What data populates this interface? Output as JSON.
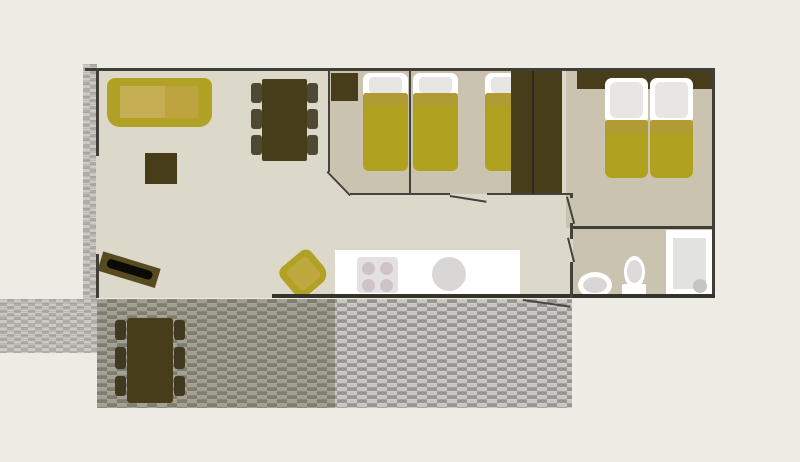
{
  "palette": {
    "background": "#edece4",
    "floor_light": "#dcd8ca",
    "floor_dark": "#c9c3b0",
    "wall": "#403e37",
    "furniture_dark_brown": "#483d1b",
    "upholstery_olive": "#b1a124",
    "cushion_light_olive": "#c4ad52",
    "bed_cover_olive": "#b0a21f",
    "bed_cover_fold": "#b19b33",
    "white": "#ffffff",
    "pillow_gray": "#e7e6e3",
    "fixture_gray": "#d9d7d5",
    "deck_gray": "#b0aea7",
    "deck_shade": "rgba(77,71,41,0.30)"
  },
  "plan": {
    "canvas": {
      "w": 800,
      "h": 462,
      "bg": "#edece4"
    },
    "elements": [
      {
        "n": "side-walkway-deck",
        "x": 83,
        "y": 64,
        "w": 14,
        "h": 236,
        "pat": "walk"
      },
      {
        "n": "front-walkway-deck",
        "x": 0,
        "y": 299,
        "w": 97,
        "h": 54,
        "pat": "walk"
      },
      {
        "n": "terrace-deck",
        "x": 97,
        "y": 299,
        "w": 475,
        "h": 109,
        "pat": "deck"
      },
      {
        "n": "terrace-deck-shade",
        "x": 97,
        "y": 299,
        "w": 238,
        "h": 109,
        "c": "rgba(77,71,41,0.30)"
      },
      {
        "n": "terrace-edge-line",
        "x": 523,
        "y": 299,
        "w": 48,
        "h": 2,
        "c": "#4a4840",
        "rot": 8,
        "org": "0 0"
      },
      {
        "n": "living-area-floor",
        "x": 96,
        "y": 68,
        "w": 619,
        "h": 230,
        "c": "#dcd8ca"
      },
      {
        "n": "bedroom1-floor",
        "x": 330,
        "y": 71,
        "w": 80,
        "h": 123,
        "c": "#c9c3b0",
        "clip": "polygon(0 0,100% 0,100% 100%,26% 100%,0 82%)"
      },
      {
        "n": "bedroom2-floor",
        "x": 410,
        "y": 71,
        "w": 123,
        "h": 123,
        "c": "#c9c3b0"
      },
      {
        "n": "master-bedroom-floor",
        "x": 566,
        "y": 71,
        "w": 146,
        "h": 157,
        "c": "#c9c3b0"
      },
      {
        "n": "bathroom-floor",
        "x": 573,
        "y": 228,
        "w": 139,
        "h": 70,
        "c": "#c9c3b0"
      },
      {
        "n": "sofa",
        "x": 107,
        "y": 78,
        "w": 105,
        "h": 49,
        "c": "#b1a124",
        "r": "8px 8px 13px 13px"
      },
      {
        "n": "sofa-cushion-left",
        "x": 120,
        "y": 86,
        "w": 45,
        "h": 32,
        "c": "#c4ad52"
      },
      {
        "n": "sofa-cushion-right",
        "x": 165,
        "y": 86,
        "w": 33,
        "h": 32,
        "c": "#bda43e"
      },
      {
        "n": "coffee-table",
        "x": 145,
        "y": 153,
        "w": 32,
        "h": 31,
        "c": "#483d1b"
      },
      {
        "n": "dining-chair",
        "x": 251,
        "y": 83,
        "w": 11,
        "h": 20,
        "c": "#4f4933",
        "r": "3px"
      },
      {
        "n": "dining-chair",
        "x": 251,
        "y": 109,
        "w": 11,
        "h": 20,
        "c": "#4f4933",
        "r": "3px"
      },
      {
        "n": "dining-chair",
        "x": 251,
        "y": 135,
        "w": 11,
        "h": 20,
        "c": "#4f4933",
        "r": "3px"
      },
      {
        "n": "dining-chair",
        "x": 307,
        "y": 83,
        "w": 11,
        "h": 20,
        "c": "#4f4933",
        "r": "3px"
      },
      {
        "n": "dining-chair",
        "x": 307,
        "y": 109,
        "w": 11,
        "h": 20,
        "c": "#4f4933",
        "r": "3px"
      },
      {
        "n": "dining-chair",
        "x": 307,
        "y": 135,
        "w": 11,
        "h": 20,
        "c": "#4f4933",
        "r": "3px"
      },
      {
        "n": "dining-table",
        "x": 262,
        "y": 79,
        "w": 45,
        "h": 82,
        "c": "#483d1b",
        "r": "2px"
      },
      {
        "n": "tv-unit",
        "x": 99,
        "y": 258,
        "w": 62,
        "h": 24,
        "rot": 17,
        "ch": [
          {
            "n": "tv-bench",
            "x": 0,
            "y": 2,
            "w": 60,
            "h": 20,
            "c": "#564a1e"
          },
          {
            "n": "tv-screen",
            "x": 7,
            "y": 7,
            "w": 47,
            "h": 9,
            "c": "#0b0a07",
            "r": "4px"
          }
        ]
      },
      {
        "n": "armchair",
        "x": 282,
        "y": 252,
        "w": 42,
        "h": 42,
        "rot": -40,
        "ch": [
          {
            "n": "armchair-body",
            "x": 1,
            "y": 3,
            "w": 40,
            "h": 38,
            "c": "#b1a124",
            "r": "8px 8px 12px 12px"
          },
          {
            "n": "armchair-cushion",
            "x": 8,
            "y": 9,
            "w": 26,
            "h": 26,
            "c": "#bfa83e",
            "r": "4px"
          }
        ]
      },
      {
        "n": "bedroom1-cabinet",
        "x": 331,
        "y": 73,
        "w": 27,
        "h": 28,
        "c": "#483d1b"
      },
      {
        "n": "single-bed",
        "x": 363,
        "y": 73,
        "w": 45,
        "h": 98,
        "ch": [
          {
            "n": "bed-mattress",
            "x": 0,
            "y": 0,
            "w": 45,
            "h": 37,
            "c": "#ffffff",
            "r": "7px 7px 2px 2px"
          },
          {
            "n": "bed-pillow",
            "x": 6,
            "y": 4,
            "w": 33,
            "h": 16,
            "c": "#e7e6e3",
            "r": "4px"
          },
          {
            "n": "bed-cover",
            "x": 0,
            "y": 20,
            "w": 45,
            "h": 78,
            "c": "#b0a21f",
            "r": "3px 3px 6px 6px"
          },
          {
            "n": "bed-cover-fold",
            "x": 0,
            "y": 20,
            "w": 45,
            "h": 13,
            "c": "#b19b33",
            "r": "3px 3px 0 0"
          }
        ]
      },
      {
        "n": "single-bed",
        "x": 413,
        "y": 73,
        "w": 45,
        "h": 98,
        "ch": [
          {
            "n": "bed-mattress",
            "x": 0,
            "y": 0,
            "w": 45,
            "h": 37,
            "c": "#ffffff",
            "r": "7px 7px 2px 2px"
          },
          {
            "n": "bed-pillow",
            "x": 6,
            "y": 4,
            "w": 33,
            "h": 16,
            "c": "#e7e6e3",
            "r": "4px"
          },
          {
            "n": "bed-cover",
            "x": 0,
            "y": 20,
            "w": 45,
            "h": 78,
            "c": "#b0a21f",
            "r": "3px 3px 6px 6px"
          },
          {
            "n": "bed-cover-fold",
            "x": 0,
            "y": 20,
            "w": 45,
            "h": 13,
            "c": "#b19b33",
            "r": "3px 3px 0 0"
          }
        ]
      },
      {
        "n": "single-bed",
        "x": 485,
        "y": 73,
        "w": 45,
        "h": 98,
        "ch": [
          {
            "n": "bed-mattress",
            "x": 0,
            "y": 0,
            "w": 45,
            "h": 37,
            "c": "#ffffff",
            "r": "7px 7px 2px 2px"
          },
          {
            "n": "bed-pillow",
            "x": 6,
            "y": 4,
            "w": 33,
            "h": 16,
            "c": "#e7e6e3",
            "r": "4px"
          },
          {
            "n": "bed-cover",
            "x": 0,
            "y": 20,
            "w": 45,
            "h": 78,
            "c": "#b0a21f",
            "r": "3px 3px 6px 6px"
          },
          {
            "n": "bed-cover-fold",
            "x": 0,
            "y": 20,
            "w": 45,
            "h": 13,
            "c": "#b19b33",
            "r": "3px 3px 0 0"
          }
        ]
      },
      {
        "n": "bedroom2-wardrobe",
        "x": 511,
        "y": 71,
        "w": 21,
        "h": 123,
        "c": "#483d1b"
      },
      {
        "n": "master-wardrobe",
        "x": 534,
        "y": 71,
        "w": 28,
        "h": 123,
        "c": "#483d1b"
      },
      {
        "n": "master-headboard",
        "x": 577,
        "y": 71,
        "w": 135,
        "h": 18,
        "c": "#483d1b"
      },
      {
        "n": "double-bed-half",
        "x": 605,
        "y": 78,
        "w": 43,
        "h": 100,
        "ch": [
          {
            "n": "bed-mattress",
            "x": 0,
            "y": 0,
            "w": 43,
            "h": 46,
            "c": "#ffffff",
            "r": "7px"
          },
          {
            "n": "bed-pillow",
            "x": 5,
            "y": 4,
            "w": 33,
            "h": 36,
            "c": "#e7e6e3",
            "r": "6px"
          },
          {
            "n": "bed-cover",
            "x": 0,
            "y": 42,
            "w": 43,
            "h": 58,
            "c": "#b0a21f",
            "r": "3px 3px 7px 7px"
          },
          {
            "n": "bed-cover-fold",
            "x": 0,
            "y": 42,
            "w": 43,
            "h": 14,
            "c": "#b19b33",
            "r": "3px 3px 0 0"
          }
        ]
      },
      {
        "n": "double-bed-half",
        "x": 650,
        "y": 78,
        "w": 43,
        "h": 100,
        "ch": [
          {
            "n": "bed-mattress",
            "x": 0,
            "y": 0,
            "w": 43,
            "h": 46,
            "c": "#ffffff",
            "r": "7px"
          },
          {
            "n": "bed-pillow",
            "x": 5,
            "y": 4,
            "w": 33,
            "h": 36,
            "c": "#e7e6e3",
            "r": "6px"
          },
          {
            "n": "bed-cover",
            "x": 0,
            "y": 42,
            "w": 43,
            "h": 58,
            "c": "#b0a21f",
            "r": "3px 3px 7px 7px"
          },
          {
            "n": "bed-cover-fold",
            "x": 0,
            "y": 42,
            "w": 43,
            "h": 14,
            "c": "#b19b33",
            "r": "3px 3px 0 0"
          }
        ]
      },
      {
        "n": "kitchen-counter",
        "x": 335,
        "y": 250,
        "w": 185,
        "h": 45,
        "c": "#ffffff"
      },
      {
        "n": "stove",
        "x": 357,
        "y": 257,
        "w": 41,
        "h": 36,
        "c": "#e4e2e0",
        "r": "4px"
      },
      {
        "n": "stove-burner",
        "t": "ellipse",
        "x": 362,
        "y": 262,
        "w": 13,
        "h": 13,
        "c": "#cfc2c8"
      },
      {
        "n": "stove-burner",
        "t": "ellipse",
        "x": 380,
        "y": 262,
        "w": 13,
        "h": 13,
        "c": "#cfc2c8"
      },
      {
        "n": "stove-burner",
        "t": "ellipse",
        "x": 362,
        "y": 279,
        "w": 13,
        "h": 13,
        "c": "#cfc2c8"
      },
      {
        "n": "stove-burner",
        "t": "ellipse",
        "x": 380,
        "y": 279,
        "w": 13,
        "h": 13,
        "c": "#cfc2c8"
      },
      {
        "n": "kitchen-sink",
        "t": "ellipse",
        "x": 432,
        "y": 257,
        "w": 34,
        "h": 34,
        "c": "#d9d7d5"
      },
      {
        "n": "shower",
        "x": 666,
        "y": 230,
        "w": 47,
        "h": 66,
        "c": "#ffffff"
      },
      {
        "n": "shower-tray",
        "x": 673,
        "y": 238,
        "w": 33,
        "h": 51,
        "c": "#e2e2e1"
      },
      {
        "n": "shower-drain",
        "t": "ellipse",
        "x": 693,
        "y": 279,
        "w": 14,
        "h": 14,
        "c": "#c5c5c3"
      },
      {
        "n": "toilet-tank",
        "x": 622,
        "y": 284,
        "w": 24,
        "h": 13,
        "c": "#ffffff",
        "r": "2px"
      },
      {
        "n": "toilet-bowl",
        "t": "ellipse",
        "x": 624,
        "y": 256,
        "w": 21,
        "h": 32,
        "c": "#ffffff"
      },
      {
        "n": "toilet-seat",
        "t": "ellipse",
        "x": 627,
        "y": 260,
        "w": 15,
        "h": 23,
        "c": "#dcdbd9"
      },
      {
        "n": "bathroom-sink",
        "t": "ellipse",
        "x": 578,
        "y": 272,
        "w": 34,
        "h": 26,
        "c": "#ffffff"
      },
      {
        "n": "bathroom-sink-basin",
        "t": "ellipse",
        "x": 583,
        "y": 277,
        "w": 24,
        "h": 16,
        "c": "#d8d7d5"
      },
      {
        "n": "picnic-chair",
        "x": 115,
        "y": 320,
        "w": 11,
        "h": 20,
        "c": "#3f3920",
        "r": "3px"
      },
      {
        "n": "picnic-chair",
        "x": 115,
        "y": 347,
        "w": 11,
        "h": 22,
        "c": "#3f3920",
        "r": "3px"
      },
      {
        "n": "picnic-chair",
        "x": 115,
        "y": 376,
        "w": 11,
        "h": 20,
        "c": "#3f3920",
        "r": "3px"
      },
      {
        "n": "picnic-chair",
        "x": 174,
        "y": 320,
        "w": 11,
        "h": 20,
        "c": "#3f3920",
        "r": "3px"
      },
      {
        "n": "picnic-chair",
        "x": 174,
        "y": 347,
        "w": 11,
        "h": 22,
        "c": "#3f3920",
        "r": "3px"
      },
      {
        "n": "picnic-chair",
        "x": 174,
        "y": 376,
        "w": 11,
        "h": 20,
        "c": "#3f3920",
        "r": "3px"
      },
      {
        "n": "picnic-table",
        "x": 127,
        "y": 318,
        "w": 46,
        "h": 85,
        "c": "#483d1b",
        "r": "3px"
      },
      {
        "n": "wall-top",
        "x": 85,
        "y": 68,
        "w": 630,
        "h": 3,
        "c": "#403e37"
      },
      {
        "n": "wall-right",
        "x": 712,
        "y": 68,
        "w": 3,
        "h": 230,
        "c": "#403e37"
      },
      {
        "n": "wall-bottom",
        "x": 272,
        "y": 294,
        "w": 443,
        "h": 4,
        "c": "#35332c"
      },
      {
        "n": "wall-left-upper",
        "x": 96,
        "y": 68,
        "w": 3,
        "h": 88,
        "c": "#403e37"
      },
      {
        "n": "wall-left-lower",
        "x": 96,
        "y": 254,
        "w": 3,
        "h": 44,
        "c": "#403e37"
      },
      {
        "n": "wall-bedroom1-left",
        "x": 328,
        "y": 71,
        "w": 2,
        "h": 101,
        "c": "#45433c"
      },
      {
        "n": "wall-bedroom1-angled",
        "x": 328,
        "y": 171,
        "w": 33,
        "h": 2,
        "c": "#45433c",
        "rot": 46,
        "org": "0 0"
      },
      {
        "n": "wall-hallway-a",
        "x": 350,
        "y": 193,
        "w": 100,
        "h": 2,
        "c": "#45433c"
      },
      {
        "n": "bedroom2-door-leaf",
        "x": 450,
        "y": 195,
        "w": 37,
        "h": 2,
        "c": "#45433c",
        "rot": 9,
        "org": "0 0"
      },
      {
        "n": "wall-hallway-b",
        "x": 487,
        "y": 193,
        "w": 83,
        "h": 2,
        "c": "#45433c"
      },
      {
        "n": "wall-bedroom1-2",
        "x": 409,
        "y": 71,
        "w": 2,
        "h": 123,
        "c": "#45433c"
      },
      {
        "n": "wall-bedroom2-master",
        "x": 532,
        "y": 71,
        "w": 2,
        "h": 123,
        "c": "#2e2a1c"
      },
      {
        "n": "wall-corridor-stub",
        "x": 570,
        "y": 193,
        "w": 3,
        "h": 5,
        "c": "#45433c"
      },
      {
        "n": "master-door-leaf",
        "x": 566,
        "y": 197,
        "w": 2,
        "h": 28,
        "c": "#45433c",
        "rot": -15,
        "org": "0 0"
      },
      {
        "n": "wall-corridor-mid",
        "x": 570,
        "y": 223,
        "w": 3,
        "h": 16,
        "c": "#45433c"
      },
      {
        "n": "bathroom-door-leaf",
        "x": 567,
        "y": 238,
        "w": 2,
        "h": 25,
        "c": "#45433c",
        "rot": -14,
        "org": "0 0"
      },
      {
        "n": "wall-corridor-lower",
        "x": 570,
        "y": 262,
        "w": 3,
        "h": 36,
        "c": "#45433c"
      },
      {
        "n": "wall-master-bathroom",
        "x": 573,
        "y": 226,
        "w": 139,
        "h": 3,
        "c": "#403e37"
      }
    ]
  }
}
